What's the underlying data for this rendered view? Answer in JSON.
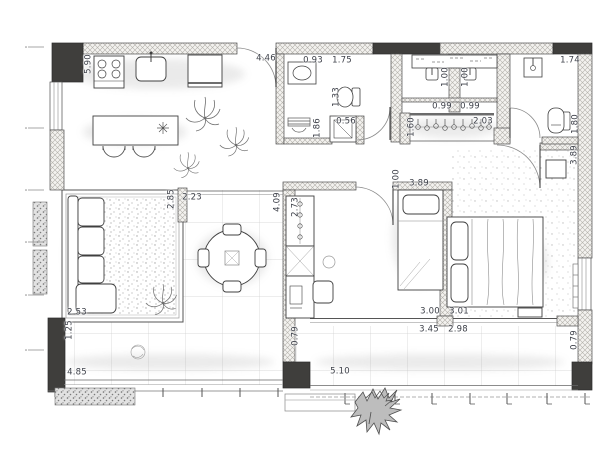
{
  "plan": {
    "kind": "apartment-floor-plan",
    "units": "m",
    "colors": {
      "paper": "#ffffff",
      "wall_hatch_line": "#b3b0ab",
      "wall_outline": "#4e4e4e",
      "column_fill": "#3f3e3c",
      "furniture_line": "#3f3f3f",
      "sketch_line": "#8b8b8b",
      "tile_line": "#cccccc",
      "dim_text": "#3d4049"
    }
  },
  "dimensions": [
    {
      "label": "5.90",
      "x": 89,
      "y": 64,
      "rot": -90
    },
    {
      "label": "4.46",
      "x": 266,
      "y": 59,
      "rot": 0
    },
    {
      "label": "0.93",
      "x": 313,
      "y": 61,
      "rot": 0
    },
    {
      "label": "1.75",
      "x": 342,
      "y": 61,
      "rot": 0
    },
    {
      "label": "1.74",
      "x": 570,
      "y": 61,
      "rot": 0
    },
    {
      "label": "1.00",
      "x": 446,
      "y": 77,
      "rot": -90
    },
    {
      "label": "1.00",
      "x": 466,
      "y": 77,
      "rot": -90
    },
    {
      "label": "1.33",
      "x": 337,
      "y": 97,
      "rot": -90
    },
    {
      "label": "0.99",
      "x": 442,
      "y": 107,
      "rot": 0
    },
    {
      "label": "0.99",
      "x": 470,
      "y": 107,
      "rot": 0
    },
    {
      "label": "1.86",
      "x": 318,
      "y": 128,
      "rot": -90
    },
    {
      "label": "0.56",
      "x": 346,
      "y": 122,
      "rot": 0
    },
    {
      "label": "1.60",
      "x": 412,
      "y": 127,
      "rot": -90
    },
    {
      "label": "2.03",
      "x": 483,
      "y": 122,
      "rot": 0
    },
    {
      "label": "1.80",
      "x": 576,
      "y": 124,
      "rot": -90
    },
    {
      "label": "3.89",
      "x": 575,
      "y": 155,
      "rot": -90
    },
    {
      "label": "1.00",
      "x": 397,
      "y": 179,
      "rot": -90
    },
    {
      "label": "3.89",
      "x": 419,
      "y": 184,
      "rot": 0
    },
    {
      "label": "2.85",
      "x": 172,
      "y": 199,
      "rot": -90
    },
    {
      "label": "2.23",
      "x": 192,
      "y": 198,
      "rot": 0
    },
    {
      "label": "4.09",
      "x": 278,
      "y": 202,
      "rot": -90
    },
    {
      "label": "2.73",
      "x": 296,
      "y": 207,
      "rot": -90
    },
    {
      "label": "2.53",
      "x": 77,
      "y": 313,
      "rot": 0
    },
    {
      "label": "1.25",
      "x": 70,
      "y": 330,
      "rot": -90
    },
    {
      "label": "0.79",
      "x": 296,
      "y": 336,
      "rot": -90
    },
    {
      "label": "3.00",
      "x": 430,
      "y": 312,
      "rot": 0
    },
    {
      "label": "3.01",
      "x": 459,
      "y": 312,
      "rot": 0
    },
    {
      "label": "3.45",
      "x": 429,
      "y": 330,
      "rot": 0
    },
    {
      "label": "2.98",
      "x": 458,
      "y": 330,
      "rot": 0
    },
    {
      "label": "4.85",
      "x": 77,
      "y": 373,
      "rot": 0
    },
    {
      "label": "5.10",
      "x": 340,
      "y": 372,
      "rot": 0
    },
    {
      "label": "0.79",
      "x": 575,
      "y": 340,
      "rot": -90
    }
  ]
}
